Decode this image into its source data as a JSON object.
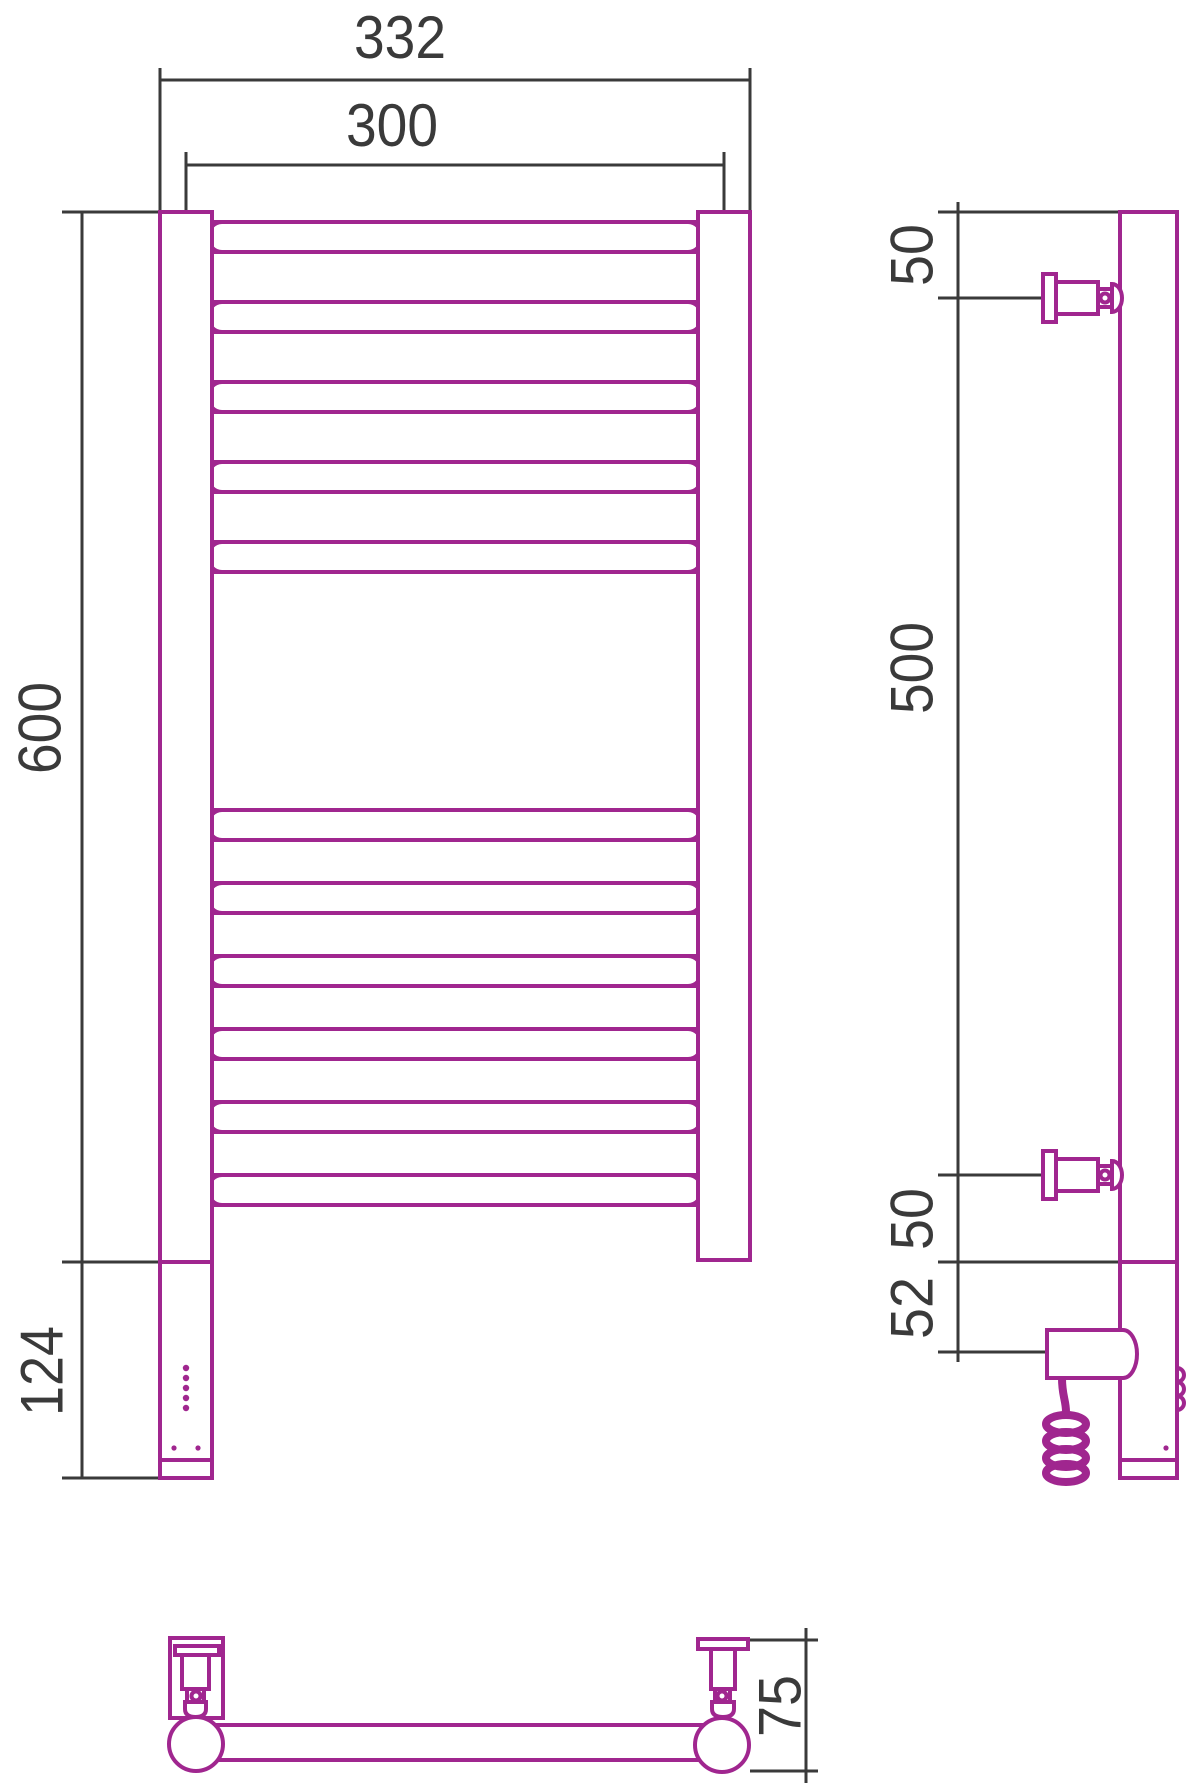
{
  "drawing": {
    "kind": "towel-rail-dimension-drawing",
    "views": [
      "front",
      "side",
      "bottom"
    ],
    "rungs": {
      "top_group": 5,
      "bottom_group": 6
    },
    "dimensions": {
      "front": {
        "overall_width": "332",
        "mounting_width": "300",
        "height": "600",
        "heater_section_height": "124"
      },
      "side": {
        "top_offset": "50",
        "mounting_span": "500",
        "bottom_offset": "50",
        "bottom_section": "52"
      },
      "bottom": {
        "depth": "75"
      }
    },
    "colors": {
      "outline": "#a0268f",
      "dimension": "#3a3a3a",
      "background": "#ffffff"
    }
  }
}
